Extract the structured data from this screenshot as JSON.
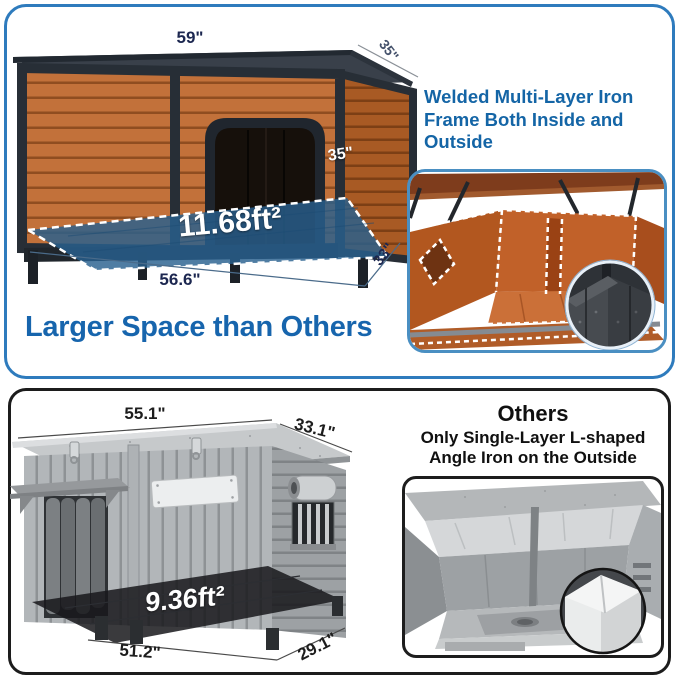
{
  "top_panel": {
    "feature_title": "Welded Multi-Layer Iron Frame Both Inside and Outside",
    "caption": "Larger Space than Others",
    "dimensions": {
      "roof_width": "59\"",
      "roof_depth": "35\"",
      "height": "35\"",
      "base_width": "56.6\"",
      "base_depth": "33\"",
      "floor_area": "11.68ft²"
    }
  },
  "bottom_panel": {
    "title": "Others",
    "subtitle": "Only Single-Layer L-shaped Angle Iron on the Outside",
    "dimensions": {
      "roof_width": "55.1\"",
      "roof_depth": "33.1\"",
      "base_width": "51.2\"",
      "base_depth": "29.1\"",
      "floor_area": "9.36ft²"
    }
  },
  "colors": {
    "panel_border_blue": "#2e7bbd",
    "panel_border_black": "#1c1c1c",
    "heading_blue": "#1465a6",
    "caption_blue": "#1765ad",
    "wood_brown": "#c2713a",
    "wood_brown_dark": "#a85a24",
    "iron_frame": "#272e36",
    "floor_overlay_blue": "#28608f",
    "floor_overlay_dark": "#17181b",
    "gray_wood": "#b2b6b9"
  }
}
